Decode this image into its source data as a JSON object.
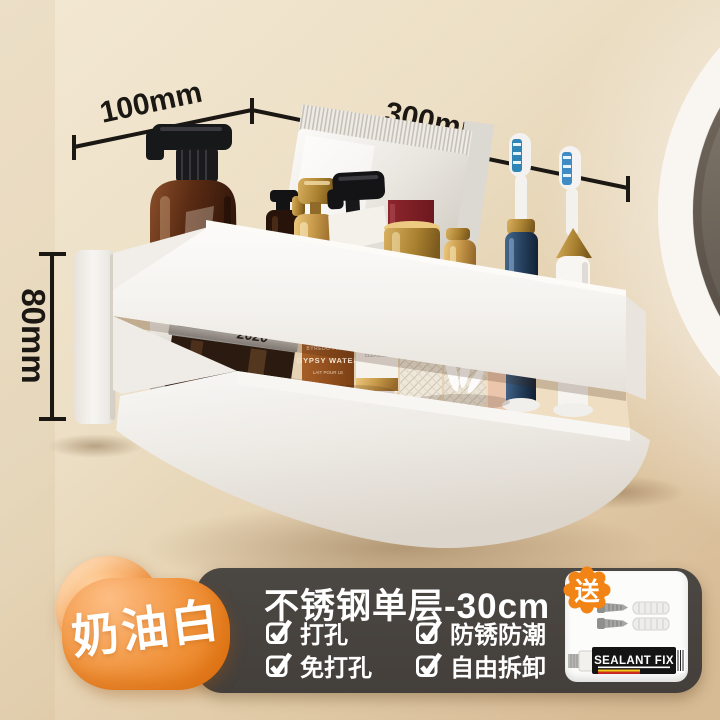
{
  "scene": {
    "dimensions": {
      "depth": "100mm",
      "width": "300mm",
      "height": "80mm"
    },
    "shelf_item_labels": {
      "jar_year": "2020",
      "amber_lines": [
        "BYREDO PARIS",
        "GYPSY WATER",
        "LAIT POUR LE"
      ],
      "cleanser_lines": [
        "FACIAL TREATMENT",
        "CLEANSER"
      ]
    }
  },
  "banner": {
    "color_name": "奶油白",
    "title": "不锈钢单层-30cm",
    "features": [
      {
        "label": "打孔"
      },
      {
        "label": "防锈防潮"
      },
      {
        "label": "免打孔"
      },
      {
        "label": "自由拆卸"
      }
    ],
    "gift_label": "送",
    "gift_product": "SEALANT FIX",
    "colors": {
      "accent_orange": "#ee8418",
      "panel_charcoal": "#474340",
      "text_white": "#ffffff"
    }
  }
}
